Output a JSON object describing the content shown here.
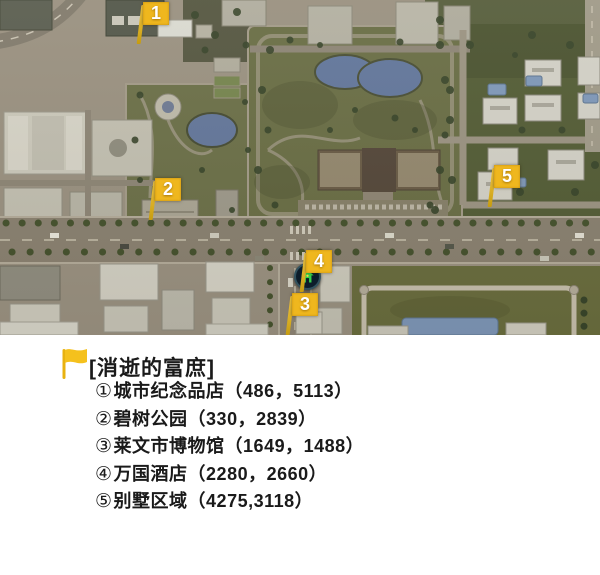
{
  "map": {
    "markers": [
      {
        "id": 1,
        "label": "1"
      },
      {
        "id": 2,
        "label": "2"
      },
      {
        "id": 3,
        "label": "3"
      },
      {
        "id": 4,
        "label": "4"
      },
      {
        "id": 5,
        "label": "5"
      }
    ]
  },
  "legend": {
    "title": "[消逝的富庶]",
    "items": [
      {
        "num": "①",
        "name": "城市纪念品店",
        "coords": "（486，5113）"
      },
      {
        "num": "②",
        "name": "碧树公园",
        "coords": "（330，2839）"
      },
      {
        "num": "③",
        "name": "莱文市博物馆",
        "coords": "（1649，1488）"
      },
      {
        "num": "④",
        "name": "万国酒店",
        "coords": "（2280，2660）"
      },
      {
        "num": "⑤",
        "name": "别墅区域",
        "coords": "（4275,3118）"
      }
    ]
  },
  "icons": {
    "marker": "flag-icon",
    "poi": "hotel-icon",
    "legend_bullet": "flag-icon"
  },
  "colors": {
    "marker_yellow": "#efb71e",
    "hotel_icon_green": "#37d24a",
    "legend_text": "#1a1a1a",
    "water_blue": "#64779a",
    "park_green": "#6a6e45"
  }
}
